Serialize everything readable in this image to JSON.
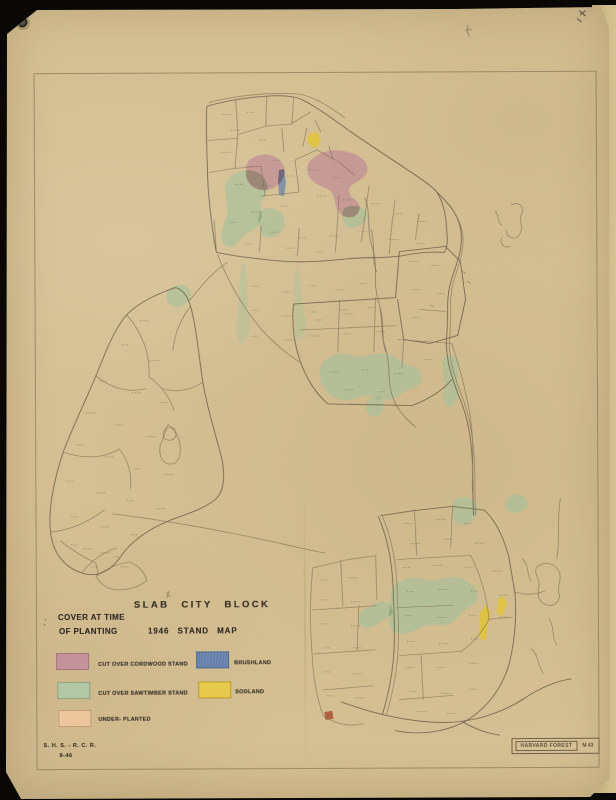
{
  "document": {
    "title": "SLAB CITY BLOCK",
    "subtitle": "1946 STAND MAP",
    "legend_heading": [
      "COVER AT TIME",
      "OF PLANTING"
    ],
    "credits": [
      "S. H. S. - R. C. R.",
      "8-46"
    ],
    "stamp": {
      "name": "HARVARD FOREST",
      "number": "M 43"
    }
  },
  "legend": {
    "items": [
      {
        "label": "CUT OVER CORDWOOD STAND",
        "color": "#c4929b"
      },
      {
        "label": "CUT OVER SAWTIMBER STAND",
        "color": "#b3c7a4"
      },
      {
        "label": "UNDER- PLANTED",
        "color": "#ecc79e"
      },
      {
        "label": "BRUSHLAND",
        "color": "#7089b0"
      },
      {
        "label": "SODLAND",
        "color": "#e7c94c"
      }
    ]
  },
  "colors": {
    "paper": "#d5c094",
    "background": "#0a0906",
    "map_line": "#7b6e55",
    "stand_cordwood": "#c08e96",
    "stand_sawtimber": "#a9c09a",
    "stand_underplanted": "#e8c19b",
    "stand_brushland": "#6d88a6",
    "stand_sodland": "#e3c437"
  }
}
